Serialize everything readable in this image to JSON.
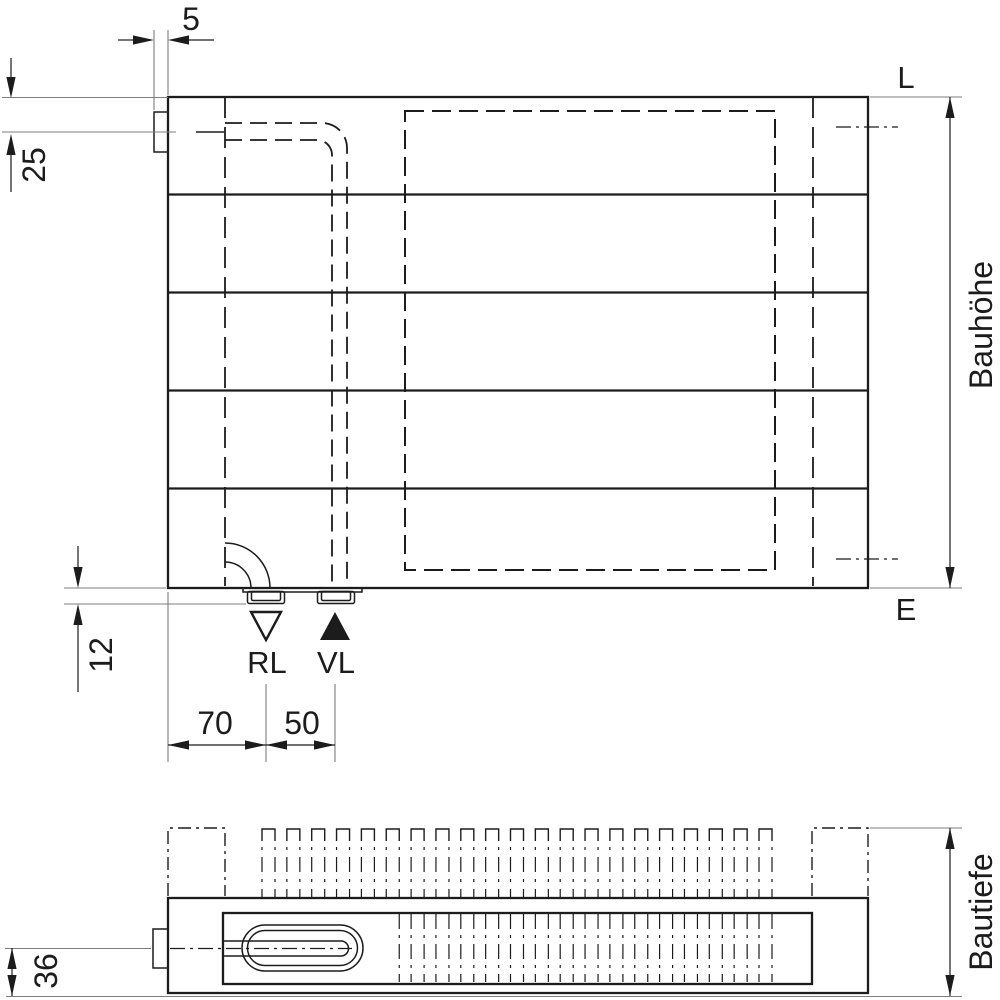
{
  "colors": {
    "line": "#1c1c1c",
    "thin_line": "#7e7e7e",
    "background": "#ffffff"
  },
  "front_view": {
    "dimensions": {
      "bracket_width": "5",
      "top_connection_offset": "25",
      "bottom_connection_depth": "12",
      "return_offset": "70",
      "supply_spacing": "50"
    },
    "labels": {
      "top_right": "L",
      "bottom_right": "E",
      "height": "Bauhöhe",
      "return": "RL",
      "supply": "VL"
    }
  },
  "plan_view": {
    "dimensions": {
      "pipe_center_offset": "36"
    },
    "labels": {
      "depth": "Bautiefe"
    }
  }
}
